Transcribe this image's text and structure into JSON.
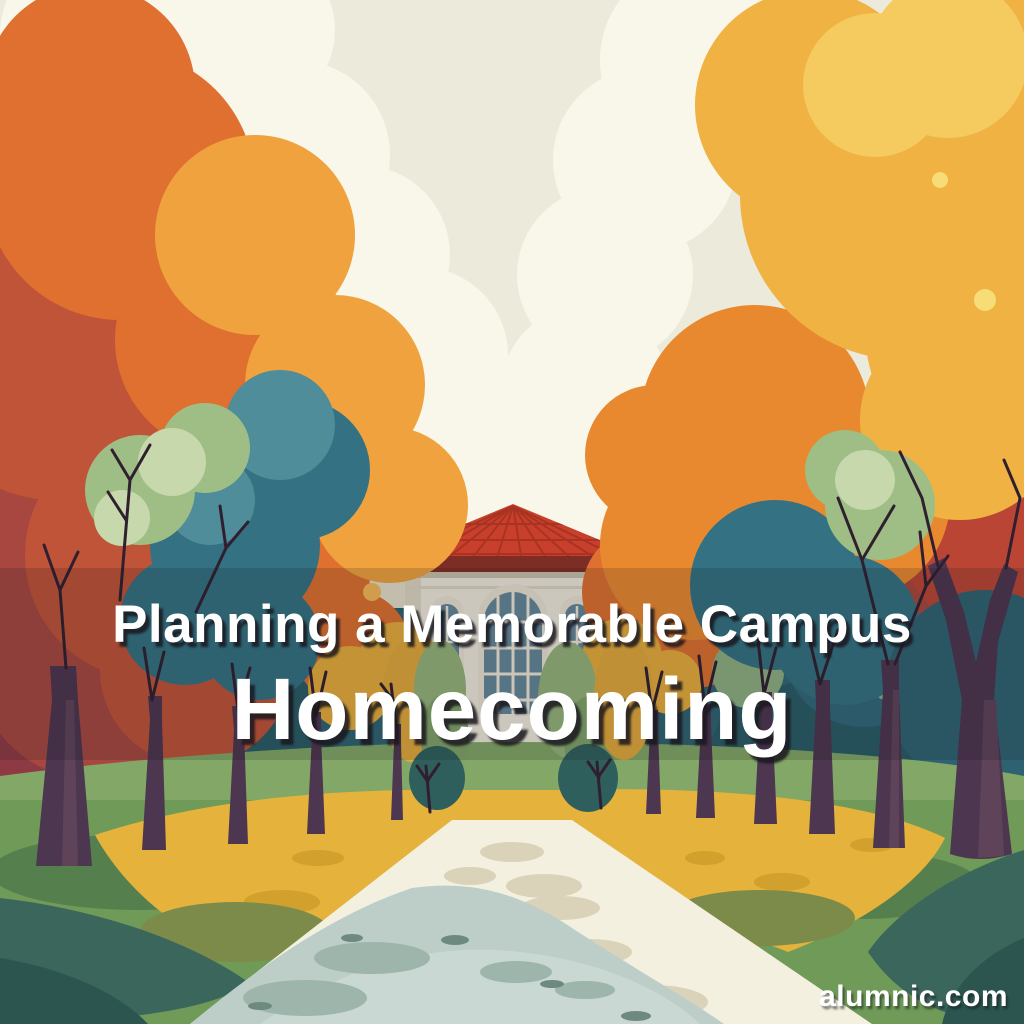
{
  "page": {
    "kind": "illustrated-article-cover"
  },
  "title": {
    "line1": "Planning a Memorable Campus",
    "line2": "Homecoming"
  },
  "watermark": {
    "text": "alumnic.com"
  },
  "palette": {
    "sky": "#ECEADB",
    "cloud": "#F8F7EA",
    "backdrop_teal": "#2A5C66",
    "orange": "#DF7030",
    "bright_orange": "#EFA23D",
    "red_orange": "#C05438",
    "red": "#BA4534",
    "maroon": "#A8473F",
    "wine": "#8E3A44",
    "gold": "#EFB243",
    "gold_light": "#F5CA5F",
    "teal": "#337183",
    "teal_light": "#4E8D99",
    "sage": "#9FBE85",
    "mint": "#C6D8AC",
    "lawn": "#6F9A58",
    "lawn_light": "#82A766",
    "ground_yellow": "#E5B23C",
    "path_cream": "#F3F0E0",
    "path_blue": "#BCCEC7",
    "mound_dark": "#2C554F",
    "trunk": "#4C3650",
    "roof_red": "#C8402B",
    "facade_cream": "#F0EBDC",
    "door_red": "#A5322E",
    "text_color": "#FFFFFF",
    "overlay_band": "rgba(24,26,32,0.17)"
  }
}
